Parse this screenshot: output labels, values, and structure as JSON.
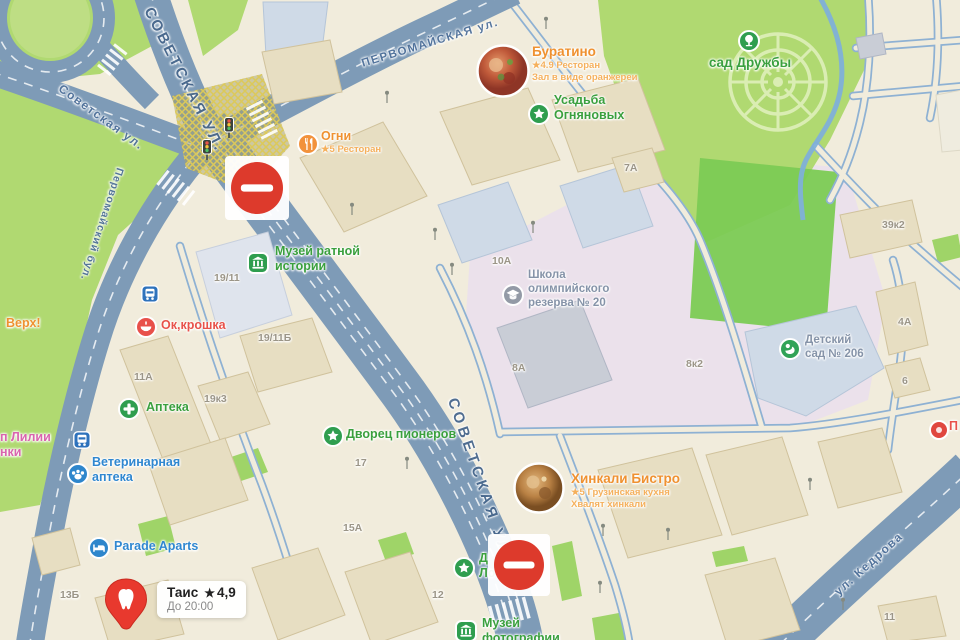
{
  "map_app": {
    "type": "map-screenshot",
    "style": "yandex-maps-like",
    "locale": "ru"
  },
  "glyphs": {
    "star": "★"
  },
  "colors": {
    "road": "#7e9bb7",
    "park": "#b0d971",
    "field": "#7ccb54",
    "school_grounds": "#ebe1eb",
    "building_beige": "#e7dec2",
    "building_bluegray": "#cfdae7",
    "poi_green": "#3aa03e",
    "poi_orange": "#ef9130",
    "poi_blue": "#2f87d0",
    "poi_red": "#e8524a",
    "no_entry": "#dd3a2c"
  },
  "streets": [
    {
      "name": "Советская ул.",
      "display": "СОВЕТСКАЯ УЛ.",
      "x": 148,
      "y": 0,
      "rotate": 63,
      "size": 15,
      "spacing": 3,
      "variant": "major"
    },
    {
      "name": "Советская ул.",
      "display": "Советская ул.",
      "x": 60,
      "y": 80,
      "rotate": 36,
      "size": 12,
      "spacing": 1.5,
      "variant": "minor"
    },
    {
      "name": "Первомайская ул.",
      "display": "ПЕРВОМАЙСКАЯ ул.",
      "x": 362,
      "y": 58,
      "rotate": -17,
      "size": 11.5,
      "spacing": 1.5,
      "variant": "minor"
    },
    {
      "name": "Первомайский бул.",
      "display": "Первомайский бул.",
      "x": 120,
      "y": 162,
      "rotate": 108,
      "size": 10.5,
      "spacing": 1,
      "variant": "minor"
    },
    {
      "name": "Советская ул.",
      "display": "СОВЕТСКАЯ УЛ",
      "x": 452,
      "y": 390,
      "rotate": 71,
      "size": 15,
      "spacing": 4,
      "variant": "major"
    },
    {
      "name": "ул. Кедрова",
      "display": "ул. Кедрова",
      "x": 836,
      "y": 586,
      "rotate": -42,
      "size": 12,
      "spacing": 1.5,
      "variant": "minor"
    }
  ],
  "pois": [
    {
      "id": "buratino",
      "name": "Буратино",
      "sub": "★4.9 Ресторан",
      "note": "Зал в виде оранжереи",
      "color": "orange",
      "big": true,
      "icon": "photo-food",
      "icon_x": 503,
      "icon_y": 71,
      "icon_r": 27,
      "label_x": 532,
      "label_y": 44
    },
    {
      "id": "ogni",
      "name": "Огни",
      "sub": "★5 Ресторан",
      "color": "orange",
      "icon": "restaurant",
      "icon_x": 307,
      "icon_y": 143,
      "icon_r": 10,
      "label_x": 321,
      "label_y": 129
    },
    {
      "id": "sad-druzhby",
      "name": "сад Дружбы",
      "color": "green",
      "big": true,
      "icon": "tree",
      "icon_x": 750,
      "icon_y": 42,
      "icon_r": 12,
      "label_x": 700,
      "label_y": 55,
      "center_w": 100
    },
    {
      "id": "usadba-ognyanovyh",
      "name": "Усадьба Огняновых",
      "lines": [
        "Усадьба",
        "Огняновых"
      ],
      "color": "green",
      "icon": "star",
      "icon_x": 539,
      "icon_y": 114,
      "icon_r": 11,
      "label_x": 554,
      "label_y": 93
    },
    {
      "id": "muzey-ratnoy-istorii",
      "name": "Музей ратной истории",
      "lines": [
        "Музей ратной",
        "истории"
      ],
      "color": "green",
      "icon": "museum",
      "icon_x": 258,
      "icon_y": 263,
      "icon_r": 11,
      "label_x": 275,
      "label_y": 244
    },
    {
      "id": "okroshka",
      "name": "Ок,крошка",
      "color": "red",
      "icon": "bowl",
      "icon_x": 146,
      "icon_y": 327,
      "icon_r": 11,
      "label_x": 161,
      "label_y": 318
    },
    {
      "id": "apteka",
      "name": "Аптека",
      "color": "green",
      "icon": "cross",
      "icon_x": 129,
      "icon_y": 409,
      "icon_r": 11,
      "label_x": 146,
      "label_y": 400
    },
    {
      "id": "vet-apteka",
      "name": "Ветеринарная аптека",
      "lines": [
        "Ветеринарная",
        "аптека"
      ],
      "color": "blue",
      "icon": "paw",
      "icon_x": 78,
      "icon_y": 474,
      "icon_r": 11,
      "label_x": 92,
      "label_y": 455
    },
    {
      "id": "lilii",
      "name": "п Лилии",
      "lines": [
        "п Лилии",
        "нки"
      ],
      "color": "magenta",
      "icon": null,
      "label_x": 0,
      "label_y": 430
    },
    {
      "id": "parade-aparts",
      "name": "Parade Aparts",
      "color": "blue",
      "icon": "bed",
      "icon_x": 99,
      "icon_y": 548,
      "icon_r": 11,
      "label_x": 114,
      "label_y": 539
    },
    {
      "id": "tais",
      "name": "Таис",
      "rating": "4,9",
      "hours": "До 20:00",
      "color": "dark",
      "icon": "pin-tooth",
      "icon_x": 126,
      "icon_y": 603,
      "label_x": 157,
      "label_y": 581
    },
    {
      "id": "dvorets-pionerov",
      "name": "Дворец пионеров",
      "color": "green",
      "icon": "star",
      "icon_x": 332,
      "icon_y": 435,
      "icon_r": 10,
      "label_x": 346,
      "label_y": 427
    },
    {
      "id": "khinkali-bistro",
      "name": "Хинкали Бистро",
      "sub": "★5 Грузинская кухня",
      "note": "Хвалят хинкали",
      "color": "orange",
      "big": true,
      "icon": "photo-khinkali",
      "icon_x": 540,
      "icon_y": 489,
      "icon_r": 26,
      "label_x": 571,
      "label_y": 471
    },
    {
      "id": "shkola-olimp-rezerva",
      "name": "Школа олимпийского резерва № 20",
      "lines": [
        "Школа",
        "олимпийского",
        "резерва № 20"
      ],
      "color": "grayblue",
      "icon": "school",
      "icon_x": 513,
      "icon_y": 295,
      "icon_r": 11,
      "label_x": 528,
      "label_y": 269
    },
    {
      "id": "detsky-sad-206",
      "name": "Детский сад № 206",
      "lines": [
        "Детский",
        "сад № 206"
      ],
      "color": "grayblue",
      "icon": "kindergarten",
      "icon_x": 790,
      "icon_y": 349,
      "icon_r": 11,
      "label_x": 805,
      "label_y": 334
    },
    {
      "id": "muzey-fotografii",
      "name": "Музей фотографии",
      "lines": [
        "Музей",
        "фотографии"
      ],
      "color": "green",
      "icon": "museum",
      "icon_x": 466,
      "icon_y": 631,
      "icon_r": 11,
      "label_x": 482,
      "label_y": 616
    },
    {
      "id": "poi-partial-green",
      "name": "Д",
      "lines": [
        "Д",
        "Ло"
      ],
      "color": "green",
      "icon": "star",
      "icon_x": 464,
      "icon_y": 568,
      "icon_r": 11,
      "label_x": 479,
      "label_y": 551
    },
    {
      "id": "verh-partial",
      "name": "Верх!",
      "color": "orange",
      "icon": null,
      "label_x": 6,
      "label_y": 316
    },
    {
      "id": "p-partial",
      "name": "П",
      "color": "red",
      "icon": "dot-red",
      "icon_x": 937,
      "icon_y": 428,
      "icon_r": 9,
      "label_x": 949,
      "label_y": 419
    }
  ],
  "building_numbers": [
    {
      "label": "19/11",
      "x": 214,
      "y": 272
    },
    {
      "label": "19/11Б",
      "x": 258,
      "y": 332
    },
    {
      "label": "11А",
      "x": 134,
      "y": 371
    },
    {
      "label": "19к3",
      "x": 204,
      "y": 393
    },
    {
      "label": "17",
      "x": 355,
      "y": 457
    },
    {
      "label": "15А",
      "x": 343,
      "y": 522
    },
    {
      "label": "13Б",
      "x": 60,
      "y": 589
    },
    {
      "label": "12",
      "x": 432,
      "y": 589
    },
    {
      "label": "7А",
      "x": 624,
      "y": 162
    },
    {
      "label": "10А",
      "x": 492,
      "y": 255
    },
    {
      "label": "8А",
      "x": 512,
      "y": 362
    },
    {
      "label": "8к2",
      "x": 686,
      "y": 358
    },
    {
      "label": "39к2",
      "x": 882,
      "y": 219
    },
    {
      "label": "4А",
      "x": 898,
      "y": 316
    },
    {
      "label": "6",
      "x": 902,
      "y": 375
    },
    {
      "label": "11",
      "x": 884,
      "y": 611
    }
  ],
  "markers": {
    "no_entry_signs": [
      {
        "x": 257,
        "y": 188,
        "r": 26
      },
      {
        "x": 519,
        "y": 565,
        "r": 25
      }
    ],
    "traffic_lights": [
      {
        "x": 207,
        "y": 150
      },
      {
        "x": 229,
        "y": 128
      }
    ],
    "transit_stops": [
      {
        "x": 150,
        "y": 294
      },
      {
        "x": 82,
        "y": 440
      }
    ],
    "street_lamps": [
      [
        387,
        100
      ],
      [
        546,
        26
      ],
      [
        352,
        212
      ],
      [
        435,
        237
      ],
      [
        533,
        230
      ],
      [
        452,
        272
      ],
      [
        407,
        466
      ],
      [
        603,
        533
      ],
      [
        668,
        537
      ],
      [
        600,
        590
      ],
      [
        810,
        487
      ],
      [
        843,
        607
      ]
    ]
  }
}
